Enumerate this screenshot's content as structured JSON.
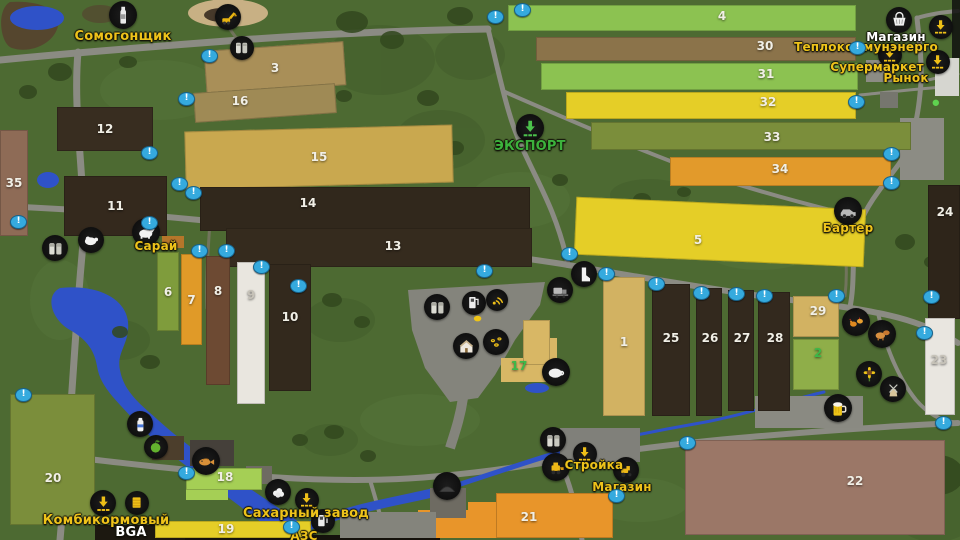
{
  "map": {
    "marker_glyph": "!",
    "accent_colors": {
      "poi_label_yellow": "#eec31a",
      "export_green": "#3cb23c",
      "marker_blue": "#35aade",
      "label_white": "#ffffff"
    },
    "fields": [
      {
        "n": "3",
        "x": 205,
        "y": 46,
        "w": 140,
        "h": 44,
        "c": "#a98f58",
        "rot": -4
      },
      {
        "n": "16",
        "x": 194,
        "y": 88,
        "w": 142,
        "h": 30,
        "c": "#9f8a55",
        "rot": -4,
        "lx": 240,
        "ly": 101
      },
      {
        "n": "12",
        "x": 57,
        "y": 107,
        "w": 96,
        "h": 44,
        "c": "#382d20"
      },
      {
        "n": "15",
        "x": 185,
        "y": 128,
        "w": 268,
        "h": 58,
        "c": "#c9a84f",
        "rot": -1.5
      },
      {
        "n": "35",
        "x": 0,
        "y": 130,
        "w": 28,
        "h": 106,
        "c": "#8e6b56"
      },
      {
        "n": "11",
        "x": 64,
        "y": 176,
        "w": 103,
        "h": 60,
        "c": "#34291d"
      },
      {
        "n": "14",
        "x": 200,
        "y": 187,
        "w": 330,
        "h": 44,
        "c": "#31281c",
        "lx": 308,
        "ly": 203
      },
      {
        "n": "13",
        "x": 226,
        "y": 228,
        "w": 306,
        "h": 39,
        "c": "#352b1e",
        "lx": 393,
        "ly": 246
      },
      {
        "n": "5",
        "x": 575,
        "y": 203,
        "w": 290,
        "h": 58,
        "c": "#e5ce27",
        "rot": 2.5,
        "lx": 698,
        "ly": 240
      },
      {
        "n": "24",
        "x": 928,
        "y": 185,
        "w": 32,
        "h": 134,
        "c": "#2e251a",
        "lx": 945,
        "ly": 212
      },
      {
        "n": "6",
        "x": 157,
        "y": 252,
        "w": 22,
        "h": 79,
        "c": "#7f9c3c"
      },
      {
        "n": "7",
        "x": 181,
        "y": 254,
        "w": 21,
        "h": 91,
        "c": "#e09a28"
      },
      {
        "n": "8",
        "x": 206,
        "y": 256,
        "w": 24,
        "h": 129,
        "c": "#6d4a33",
        "lx": 218,
        "ly": 291
      },
      {
        "n": "9",
        "x": 237,
        "y": 262,
        "w": 28,
        "h": 142,
        "c": "#e9e6df",
        "tc": "#c6c2b8",
        "lx": 251,
        "ly": 295
      },
      {
        "n": "10",
        "x": 269,
        "y": 264,
        "w": 42,
        "h": 127,
        "c": "#33291d",
        "lx": 290,
        "ly": 317
      },
      {
        "n": "4",
        "x": 508,
        "y": 5,
        "w": 348,
        "h": 26,
        "c": "#8cc251",
        "lx": 722,
        "ly": 16
      },
      {
        "n": "30",
        "x": 536,
        "y": 37,
        "w": 320,
        "h": 24,
        "c": "#8b734a",
        "lx": 765,
        "ly": 46
      },
      {
        "n": "31",
        "x": 541,
        "y": 63,
        "w": 317,
        "h": 27,
        "c": "#8cc251",
        "lx": 766,
        "ly": 74
      },
      {
        "n": "32",
        "x": 566,
        "y": 92,
        "w": 290,
        "h": 27,
        "c": "#e5ce27",
        "lx": 768,
        "ly": 102
      },
      {
        "n": "33",
        "x": 591,
        "y": 122,
        "w": 320,
        "h": 28,
        "c": "#7b8e3b",
        "lx": 772,
        "ly": 137
      },
      {
        "n": "34",
        "x": 670,
        "y": 157,
        "w": 221,
        "h": 29,
        "c": "#e29a2b",
        "lx": 780,
        "ly": 169
      },
      {
        "n": "1",
        "x": 603,
        "y": 277,
        "w": 42,
        "h": 139,
        "c": "#d2b262",
        "lx": 624,
        "ly": 342
      },
      {
        "n": "25",
        "x": 652,
        "y": 284,
        "w": 38,
        "h": 132,
        "c": "#33291e",
        "lx": 671,
        "ly": 338
      },
      {
        "n": "26",
        "x": 696,
        "y": 288,
        "w": 26,
        "h": 128,
        "c": "#33291e",
        "lx": 710,
        "ly": 338
      },
      {
        "n": "27",
        "x": 728,
        "y": 290,
        "w": 26,
        "h": 121,
        "c": "#33291e",
        "lx": 742,
        "ly": 338
      },
      {
        "n": "28",
        "x": 758,
        "y": 292,
        "w": 32,
        "h": 119,
        "c": "#33291e",
        "lx": 775,
        "ly": 338
      },
      {
        "n": "29",
        "x": 793,
        "y": 296,
        "w": 46,
        "h": 41,
        "c": "#d2b262",
        "lx": 818,
        "ly": 311
      },
      {
        "n": "2",
        "x": 793,
        "y": 339,
        "w": 46,
        "h": 51,
        "c": "#8fae49",
        "tc": "#3db849",
        "lx": 818,
        "ly": 353
      },
      {
        "n": "23",
        "x": 925,
        "y": 318,
        "w": 30,
        "h": 97,
        "c": "#e9e6e0",
        "tc": "#c6c2b8",
        "lx": 939,
        "ly": 360
      },
      {
        "n": "20",
        "x": 10,
        "y": 394,
        "w": 85,
        "h": 131,
        "c": "#7b8e3b",
        "lx": 53,
        "ly": 478
      },
      {
        "n": "18",
        "x": 186,
        "y": 468,
        "w": 76,
        "h": 22,
        "c": "#a5cf55",
        "lx": 225,
        "ly": 477
      },
      {
        "n": "19",
        "x": 155,
        "y": 521,
        "w": 156,
        "h": 17,
        "c": "#e5ce27",
        "lx": 226,
        "ly": 529
      },
      {
        "n": "21",
        "x": 496,
        "y": 493,
        "w": 117,
        "h": 45,
        "c": "#e8952a",
        "lx": 529,
        "ly": 517
      },
      {
        "n": "22",
        "x": 685,
        "y": 440,
        "w": 260,
        "h": 95,
        "c": "#9b7767",
        "lx": 855,
        "ly": 481
      },
      {
        "n": "17",
        "x": 523,
        "y": 320,
        "w": 27,
        "h": 45,
        "c": "#d8b765",
        "tc": "#3db849",
        "lx": 519,
        "ly": 366
      }
    ],
    "patches": [
      {
        "x": 186,
        "y": 486,
        "w": 42,
        "h": 14,
        "c": "#a5cf55"
      },
      {
        "x": 468,
        "y": 502,
        "w": 30,
        "h": 36,
        "c": "#e8952a"
      },
      {
        "x": 418,
        "y": 510,
        "w": 52,
        "h": 28,
        "c": "#e8952a"
      },
      {
        "x": 501,
        "y": 358,
        "w": 54,
        "h": 24,
        "c": "#d8b765"
      },
      {
        "x": 543,
        "y": 338,
        "w": 14,
        "h": 22,
        "c": "#d8b765"
      }
    ],
    "structures": [
      {
        "x": 900,
        "y": 118,
        "w": 44,
        "h": 62,
        "c": "#8c8c84"
      },
      {
        "x": 935,
        "y": 58,
        "w": 24,
        "h": 38,
        "c": "#d6d6d0"
      },
      {
        "x": 866,
        "y": 60,
        "w": 28,
        "h": 22,
        "c": "#8c8c84"
      },
      {
        "x": 880,
        "y": 92,
        "w": 18,
        "h": 16,
        "c": "#76766e"
      },
      {
        "x": 152,
        "y": 436,
        "w": 32,
        "h": 24,
        "c": "#4c3e2c"
      },
      {
        "x": 190,
        "y": 440,
        "w": 44,
        "h": 26,
        "c": "#45403a"
      },
      {
        "x": 246,
        "y": 466,
        "w": 26,
        "h": 18,
        "c": "#6e6b62"
      },
      {
        "x": 755,
        "y": 396,
        "w": 108,
        "h": 32,
        "c": "#8a8a82"
      },
      {
        "x": 430,
        "y": 488,
        "w": 36,
        "h": 30,
        "c": "#6e6b62"
      },
      {
        "x": 340,
        "y": 512,
        "w": 96,
        "h": 26,
        "c": "#84847c"
      },
      {
        "x": 560,
        "y": 428,
        "w": 80,
        "h": 34,
        "c": "#80807a"
      },
      {
        "x": 162,
        "y": 236,
        "w": 22,
        "h": 12,
        "c": "#b5762a"
      },
      {
        "x": 95,
        "y": 525,
        "w": 90,
        "h": 15,
        "c": "#1c1810"
      }
    ],
    "pois": [
      {
        "name": "moonshiner",
        "icon": "bottle",
        "x": 123,
        "y": 15,
        "r": 14
      },
      {
        "name": "sandpit-excavator",
        "icon": "excavator",
        "x": 228,
        "y": 17,
        "r": 13
      },
      {
        "name": "silo-north",
        "icon": "silo",
        "x": 242,
        "y": 48,
        "r": 12
      },
      {
        "name": "shop",
        "icon": "basket",
        "x": 899,
        "y": 20,
        "r": 13
      },
      {
        "name": "heat-plant-delivery",
        "icon": "unload",
        "x": 941,
        "y": 27,
        "r": 12
      },
      {
        "name": "supermarket-delivery",
        "icon": "unload",
        "x": 890,
        "y": 55,
        "r": 12
      },
      {
        "name": "market-delivery",
        "icon": "unload",
        "x": 938,
        "y": 62,
        "r": 12
      },
      {
        "name": "export",
        "icon": "export",
        "x": 530,
        "y": 128,
        "r": 14
      },
      {
        "name": "barter",
        "icon": "vehicle",
        "x": 848,
        "y": 211,
        "r": 14
      },
      {
        "name": "silo-west",
        "icon": "silo",
        "x": 55,
        "y": 248,
        "r": 13
      },
      {
        "name": "sheep-barn",
        "icon": "sheep",
        "x": 91,
        "y": 240,
        "r": 13
      },
      {
        "name": "cow-barn",
        "icon": "cow",
        "x": 146,
        "y": 232,
        "r": 14
      },
      {
        "name": "farm-silo",
        "icon": "silo",
        "x": 437,
        "y": 307,
        "r": 13
      },
      {
        "name": "farm-fuel",
        "icon": "fuel",
        "x": 474,
        "y": 303,
        "r": 12
      },
      {
        "name": "radio-signal",
        "icon": "wifi",
        "x": 497,
        "y": 300,
        "r": 11
      },
      {
        "name": "egg-sale",
        "icon": "egg",
        "x": 478,
        "y": 319,
        "r": 7,
        "plain": true
      },
      {
        "name": "farmhouse",
        "icon": "house",
        "x": 466,
        "y": 346,
        "r": 13
      },
      {
        "name": "apiary",
        "icon": "bees",
        "x": 496,
        "y": 342,
        "r": 13
      },
      {
        "name": "pig-barn",
        "icon": "pig",
        "x": 556,
        "y": 372,
        "r": 14
      },
      {
        "name": "boot-poi",
        "icon": "boot",
        "x": 584,
        "y": 274,
        "r": 13
      },
      {
        "name": "machine-dealer",
        "icon": "harvester",
        "x": 560,
        "y": 290,
        "r": 13
      },
      {
        "name": "hen-house",
        "icon": "hens",
        "x": 856,
        "y": 322,
        "r": 14
      },
      {
        "name": "livestock-pen",
        "icon": "livestock",
        "x": 882,
        "y": 334,
        "r": 14
      },
      {
        "name": "sunflower-poi",
        "icon": "sunflower",
        "x": 869,
        "y": 374,
        "r": 13
      },
      {
        "name": "windmill",
        "icon": "windmill",
        "x": 893,
        "y": 389,
        "r": 13
      },
      {
        "name": "pub",
        "icon": "beer",
        "x": 838,
        "y": 408,
        "r": 14
      },
      {
        "name": "dairy",
        "icon": "milk",
        "x": 140,
        "y": 424,
        "r": 13
      },
      {
        "name": "orchard",
        "icon": "apple",
        "x": 156,
        "y": 447,
        "r": 12
      },
      {
        "name": "fishing-spot",
        "icon": "fish",
        "x": 206,
        "y": 461,
        "r": 14
      },
      {
        "name": "wool-sale",
        "icon": "wool",
        "x": 278,
        "y": 492,
        "r": 13
      },
      {
        "name": "feed-mill-delivery",
        "icon": "unload",
        "x": 103,
        "y": 503,
        "r": 13
      },
      {
        "name": "seed-store",
        "icon": "corn",
        "x": 137,
        "y": 503,
        "r": 12
      },
      {
        "name": "silage-mound",
        "icon": "mound",
        "x": 447,
        "y": 486,
        "r": 14
      },
      {
        "name": "construction-silo",
        "icon": "silo",
        "x": 553,
        "y": 440,
        "r": 13
      },
      {
        "name": "construction-loader",
        "icon": "loader",
        "x": 556,
        "y": 467,
        "r": 14
      },
      {
        "name": "construction-delivery",
        "icon": "unload",
        "x": 585,
        "y": 454,
        "r": 12
      },
      {
        "name": "construction-tractor",
        "icon": "tractor",
        "x": 626,
        "y": 470,
        "r": 13
      },
      {
        "name": "sugar-mill-delivery",
        "icon": "unload",
        "x": 307,
        "y": 500,
        "r": 12
      },
      {
        "name": "gas-station",
        "icon": "fuel",
        "x": 323,
        "y": 521,
        "r": 12
      },
      {
        "name": "town-dot",
        "icon": "dot",
        "x": 936,
        "y": 103,
        "r": 6,
        "plain": true
      }
    ],
    "labels": [
      {
        "name": "moonshiner",
        "text": "Сомогонщик",
        "x": 123,
        "y": 37,
        "c": "#eec31a",
        "s": 13
      },
      {
        "name": "shop",
        "text": "Магазин",
        "x": 896,
        "y": 38,
        "c": "#ffffff",
        "s": 12
      },
      {
        "name": "heat-plant",
        "text": "Теплокоммунэнерго",
        "x": 866,
        "y": 48,
        "c": "#eec31a",
        "s": 12
      },
      {
        "name": "supermarket",
        "text": "Супермаркет",
        "x": 877,
        "y": 68,
        "c": "#eec31a",
        "s": 12
      },
      {
        "name": "market",
        "text": "Рынок",
        "x": 906,
        "y": 79,
        "c": "#eec31a",
        "s": 12
      },
      {
        "name": "export",
        "text": "ЭКСПОРТ",
        "x": 530,
        "y": 147,
        "c": "#3cb23c",
        "s": 13
      },
      {
        "name": "barter",
        "text": "Бартер",
        "x": 848,
        "y": 229,
        "c": "#eec31a",
        "s": 12
      },
      {
        "name": "barn",
        "text": "Сарай",
        "x": 156,
        "y": 247,
        "c": "#eec31a",
        "s": 12
      },
      {
        "name": "construction",
        "text": "Стройка",
        "x": 594,
        "y": 466,
        "c": "#eec31a",
        "s": 12
      },
      {
        "name": "construction-shop",
        "text": "Магазин",
        "x": 622,
        "y": 488,
        "c": "#eec31a",
        "s": 12
      },
      {
        "name": "feed-mill",
        "text": "Комбикормовый",
        "x": 106,
        "y": 521,
        "c": "#eec31a",
        "s": 13
      },
      {
        "name": "bga",
        "text": "BGA",
        "x": 131,
        "y": 533,
        "c": "#ffffff",
        "s": 13
      },
      {
        "name": "sugar-mill",
        "text": "Сахарный завод",
        "x": 306,
        "y": 514,
        "c": "#eec31a",
        "s": 13
      },
      {
        "name": "gas",
        "text": "АЗС",
        "x": 304,
        "y": 537,
        "c": "#eec31a",
        "s": 12
      }
    ],
    "markers": [
      {
        "x": 208,
        "y": 55
      },
      {
        "x": 185,
        "y": 98
      },
      {
        "x": 148,
        "y": 152
      },
      {
        "x": 178,
        "y": 183
      },
      {
        "x": 192,
        "y": 192
      },
      {
        "x": 17,
        "y": 221
      },
      {
        "x": 148,
        "y": 222
      },
      {
        "x": 198,
        "y": 250
      },
      {
        "x": 225,
        "y": 250
      },
      {
        "x": 260,
        "y": 266
      },
      {
        "x": 297,
        "y": 285
      },
      {
        "x": 494,
        "y": 16
      },
      {
        "x": 521,
        "y": 9
      },
      {
        "x": 568,
        "y": 253
      },
      {
        "x": 483,
        "y": 270
      },
      {
        "x": 605,
        "y": 273
      },
      {
        "x": 655,
        "y": 283
      },
      {
        "x": 700,
        "y": 292
      },
      {
        "x": 735,
        "y": 293
      },
      {
        "x": 763,
        "y": 295
      },
      {
        "x": 835,
        "y": 295
      },
      {
        "x": 856,
        "y": 47
      },
      {
        "x": 855,
        "y": 101
      },
      {
        "x": 890,
        "y": 153
      },
      {
        "x": 890,
        "y": 182
      },
      {
        "x": 930,
        "y": 296
      },
      {
        "x": 923,
        "y": 332
      },
      {
        "x": 942,
        "y": 422
      },
      {
        "x": 686,
        "y": 442
      },
      {
        "x": 22,
        "y": 394
      },
      {
        "x": 185,
        "y": 472
      },
      {
        "x": 290,
        "y": 526
      },
      {
        "x": 615,
        "y": 495
      }
    ]
  }
}
